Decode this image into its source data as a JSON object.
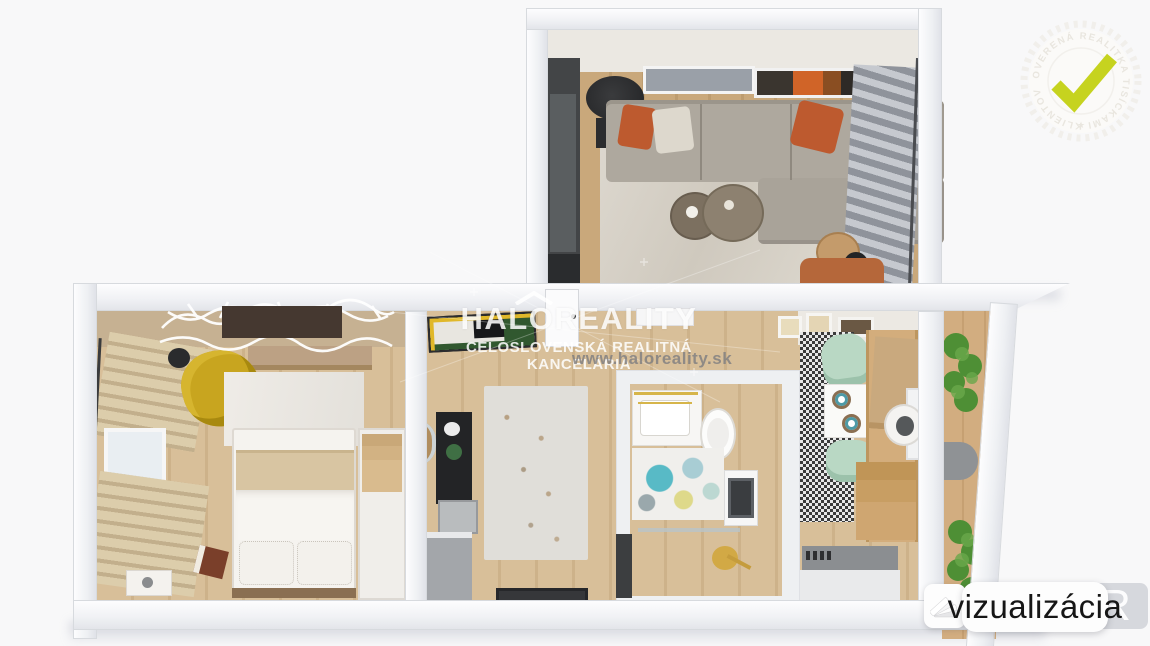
{
  "brand": {
    "name": "HALOREALITY",
    "tagline": "CELOSLOVENSKÁ REALITNÁ KANCELÁRIA",
    "website": "www.haloreality.sk"
  },
  "badge": {
    "text": "OVERENÁ REALITKA TISÍCKAMI KLIENTOV",
    "separator": "★",
    "check_color": "#c6d31f"
  },
  "label": {
    "text": "vizualizácia",
    "background_letter": "R"
  },
  "scene": {
    "type": "3d-floorplan-visualization",
    "rooms": [
      {
        "name": "living-room",
        "items": [
          "sectional-sofa",
          "orange-pillows",
          "white-pillow",
          "coffee-tables",
          "floor-lamp",
          "wall-art",
          "tall-cabinet",
          "striped-curtains",
          "side-table",
          "reading-lamp",
          "orange-armchair",
          "area-rug"
        ]
      },
      {
        "name": "bedroom",
        "items": [
          "double-bed",
          "beige-blanket",
          "pillows",
          "wardrobe",
          "yellow-armchair",
          "floor-lamp",
          "window-curtains",
          "decor-lattice-panel",
          "dresser",
          "nightstand",
          "book",
          "white-rug"
        ]
      },
      {
        "name": "hallway",
        "items": [
          "wall-art",
          "door",
          "round-mirror",
          "black-shelf",
          "gray-cabinet",
          "floral-rug",
          "doormat",
          "console-shelf"
        ]
      },
      {
        "name": "bathroom",
        "items": [
          "vanity-sink",
          "toilet",
          "washing-machine",
          "floral-rug",
          "shower-glass",
          "gold-fixture"
        ]
      },
      {
        "name": "kitchen",
        "items": [
          "dining-table",
          "mint-chairs",
          "plates",
          "checkered-mat",
          "wall-frames",
          "wood-cabinets",
          "round-sink",
          "roller-blind",
          "window",
          "gray-counter"
        ]
      },
      {
        "name": "balcony",
        "items": [
          "plants",
          "half-round-table"
        ]
      }
    ],
    "colors": {
      "background": "#f8f8f9",
      "walls": "#f2f3f6",
      "wood_floor": "#d3b890",
      "sofa_gray": "#aba49a",
      "accent_orange": "#c05a2f",
      "mustard_chair": "#c8a51f",
      "mint_chair": "#b9d8c4",
      "teal_rug": "#55b9c5",
      "gold_fixture": "#d6b54a",
      "check_lime": "#c6d31f"
    }
  }
}
